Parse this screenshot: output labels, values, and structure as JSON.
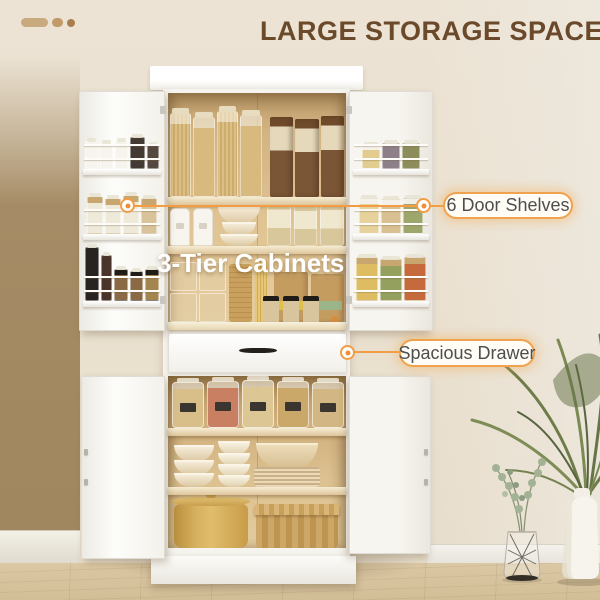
{
  "header": {
    "title": "LARGE STORAGE SPACE",
    "title_color": "#6b4a2c",
    "logo": {
      "name": "brand-logo",
      "shape_colors": [
        "#c9aa7e",
        "#c29a68",
        "#aa7c4e"
      ]
    }
  },
  "callouts": {
    "door_shelves": {
      "label": "6 Door Shelves"
    },
    "tier_cabinets": {
      "label": "3-Tier Cabinets",
      "text_color": "#ffffff"
    },
    "drawer": {
      "label": "Spacious Drawer"
    },
    "accent_color": "#f29d45",
    "pill": {
      "bg": "#fffdf6",
      "border": "#f0a24e",
      "text_color": "#4e4e4e"
    }
  }
}
